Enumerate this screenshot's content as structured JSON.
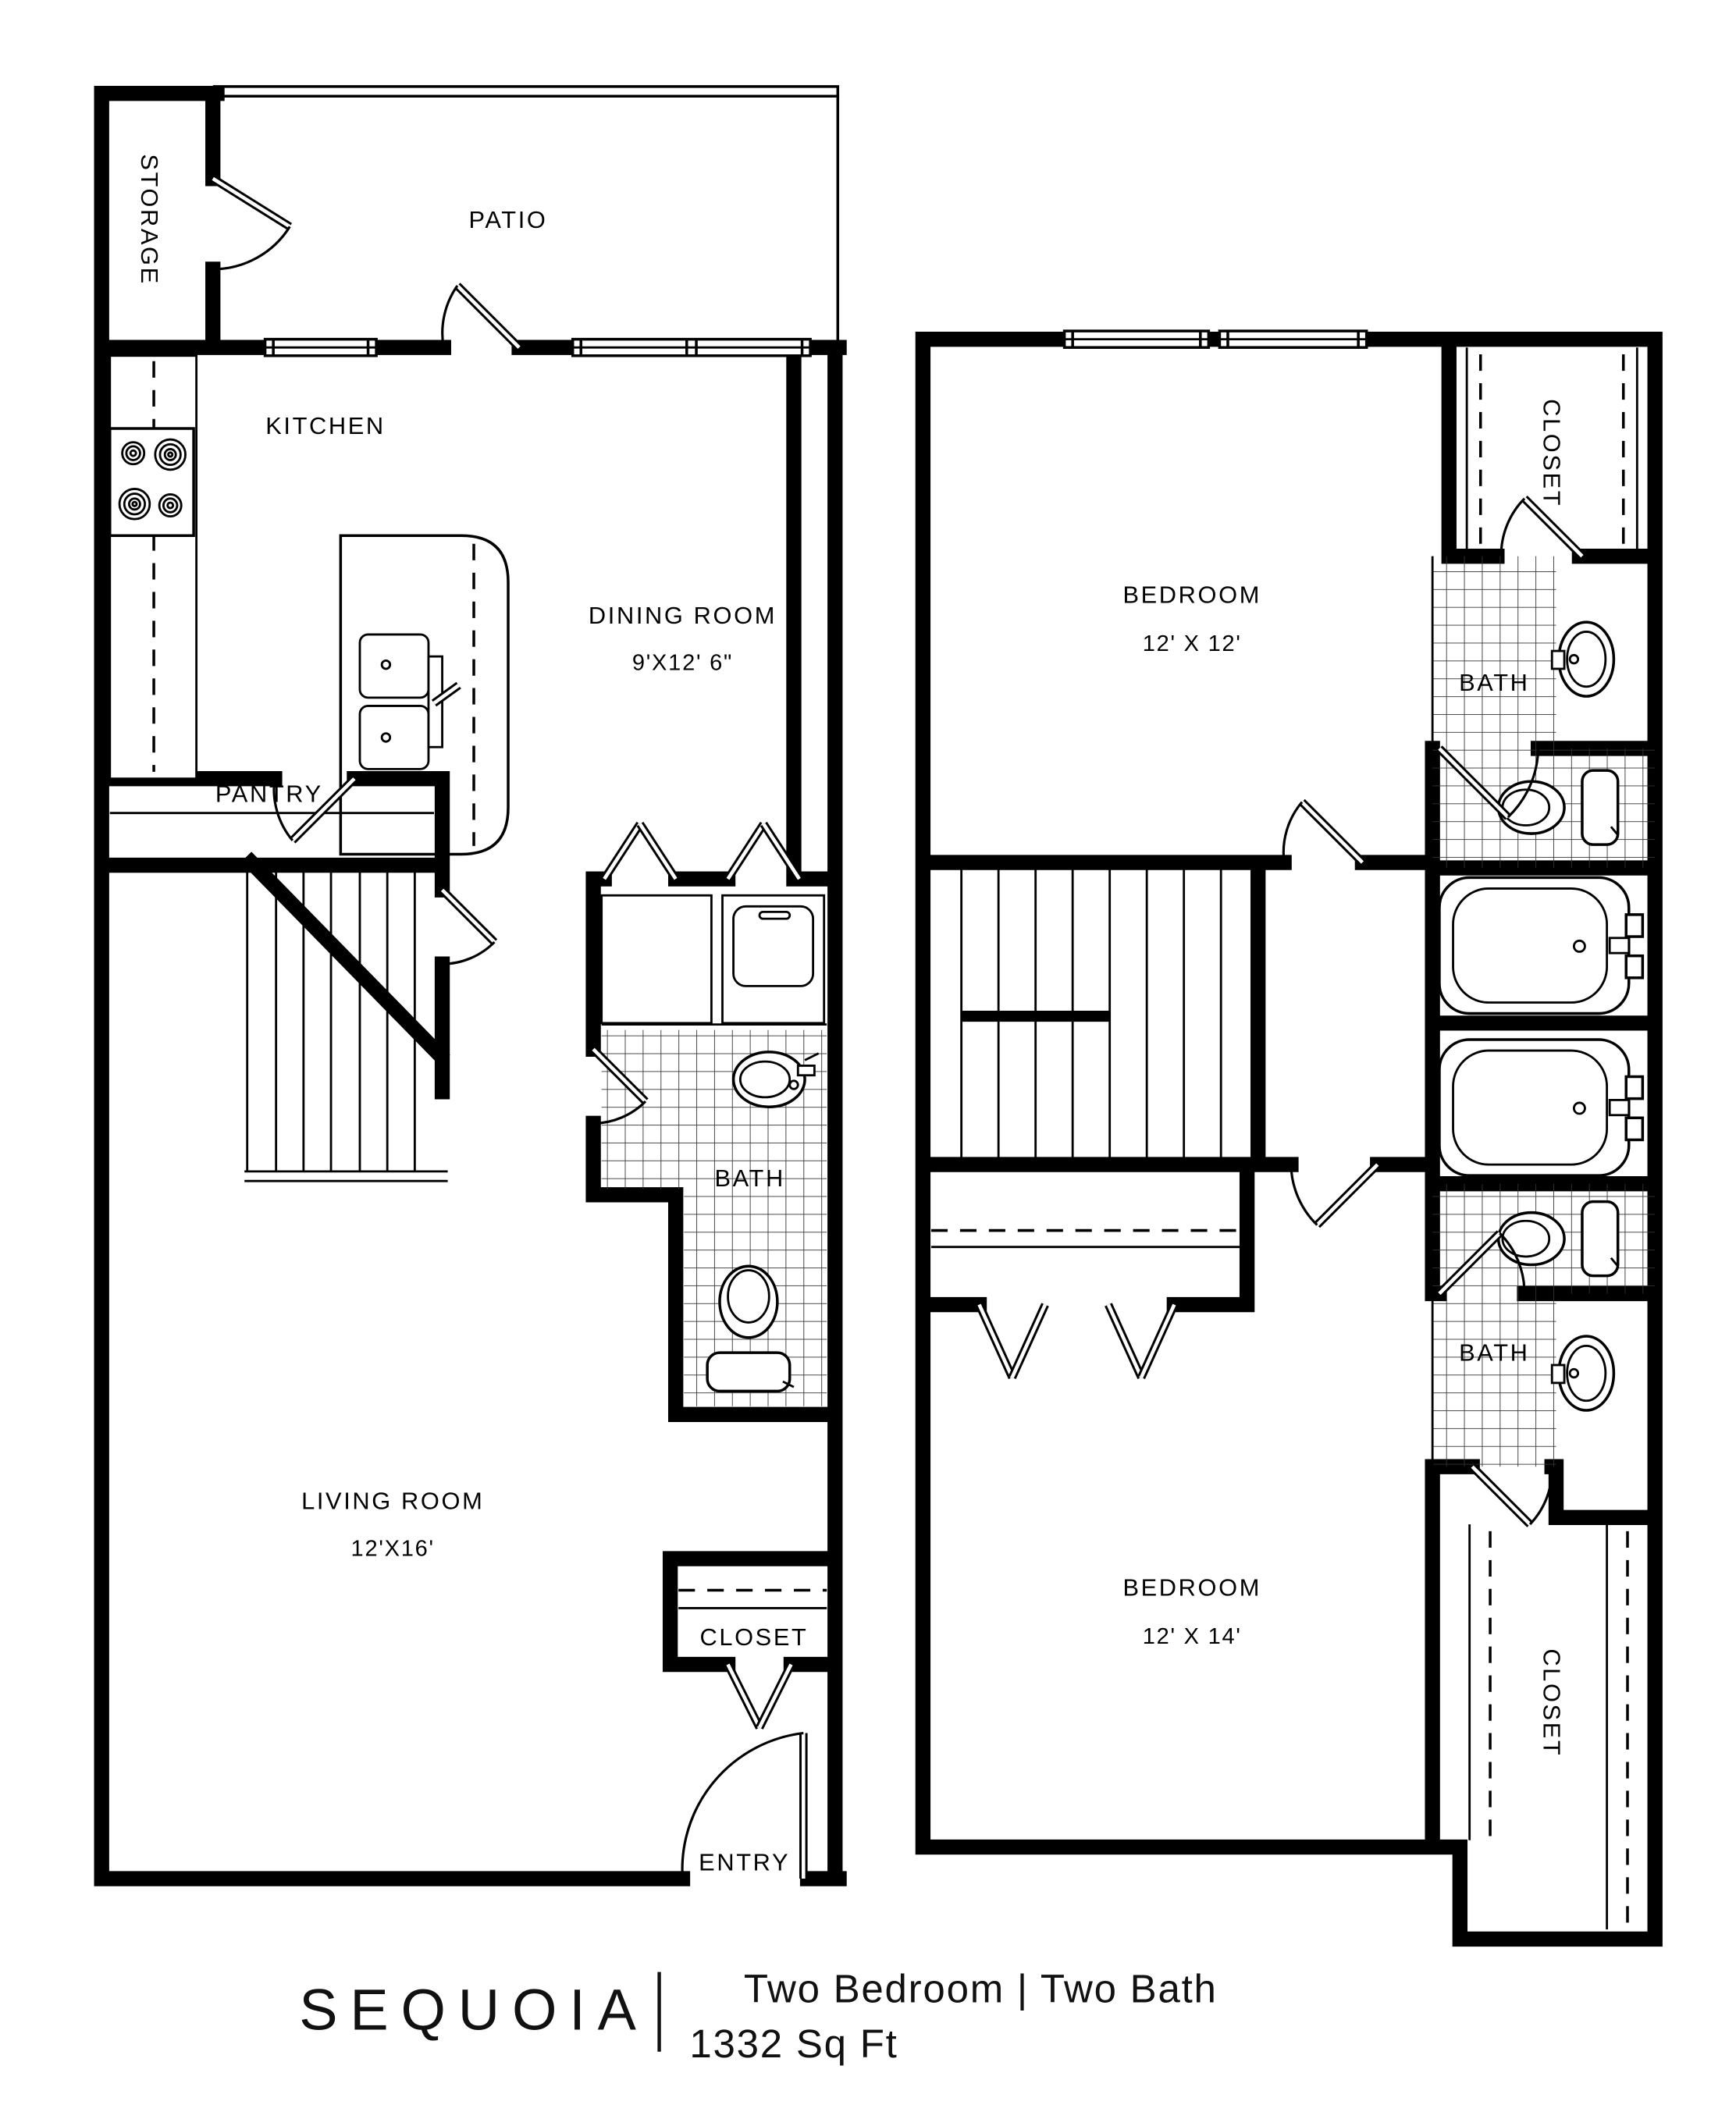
{
  "floorplan": {
    "first_floor": {
      "storage_label": "STORAGE",
      "patio_label": "PATIO",
      "kitchen_label": "KITCHEN",
      "dining": {
        "name": "DINING ROOM",
        "dims": "9'X12' 6\""
      },
      "pantry_label": "PANTRY",
      "bath_label": "BATH",
      "living": {
        "name": "LIVING ROOM",
        "dims": "12'X16'"
      },
      "closet_label": "CLOSET",
      "entry_label": "ENTRY"
    },
    "second_floor": {
      "closet_top_label": "CLOSET",
      "bedroom1": {
        "name": "BEDROOM",
        "dims": "12' X 12'"
      },
      "bath1_label": "BATH",
      "bath2_label": "BATH",
      "bedroom2": {
        "name": "BEDROOM",
        "dims": "12' X 14'"
      },
      "closet_bottom_label": "CLOSET"
    },
    "footer": {
      "plan_name": "SEQUOIA",
      "description": "Two Bedroom | Two Bath",
      "area": "1332 Sq Ft"
    },
    "colors": {
      "ink": "#000000",
      "paper": "#ffffff"
    }
  }
}
